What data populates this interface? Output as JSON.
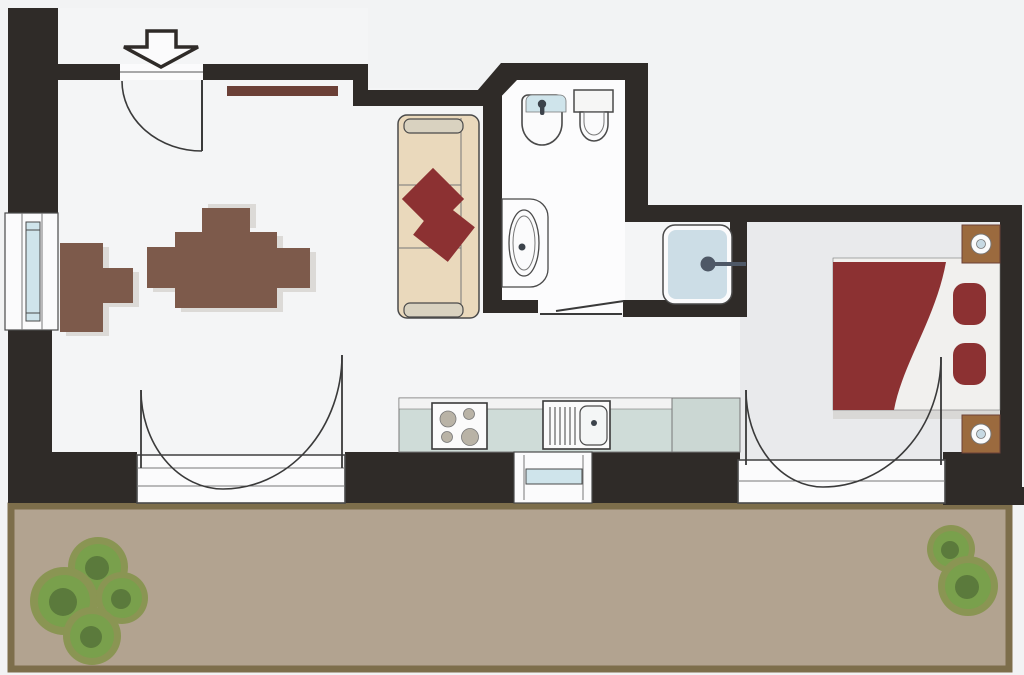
{
  "plan": {
    "type": "apartment-floor-plan",
    "rooms": [
      "living-room",
      "kitchen",
      "bathroom",
      "shower-niche",
      "bedroom",
      "terrace"
    ],
    "fixtures": [
      "entrance-arrow",
      "entrance-door",
      "wall-shelf",
      "armchair",
      "dining-table",
      "dining-chairs",
      "sofa",
      "sofa-pillows",
      "bidet",
      "toilet",
      "bathroom-sink",
      "sliding-door",
      "shower",
      "kitchen-counter",
      "stove",
      "kitchen-sink",
      "kitchen-window",
      "left-window",
      "french-door-living",
      "french-door-bedroom",
      "bed",
      "bed-pillows",
      "nightstands",
      "nightstand-lamps",
      "bushes"
    ]
  },
  "colors": {
    "background": "#f2f3f4",
    "wall": "#2f2b28",
    "floorLiving": "#f4f5f6",
    "floorBath": "#fcfcfd",
    "floorBedroom": "#e9eaec",
    "terraceFill": "#b2a390",
    "terraceBorder": "#7d6e4b",
    "glass": "#cfe4eb",
    "white": "#fbfbfc",
    "sofaBody": "#ead9bc",
    "sofaCap": "#d9d2c0",
    "accentRed": "#8c3132",
    "shelfWood": "#6b4037",
    "chairBrown": "#7d5a4b",
    "nightstandWood": "#9b6a3e",
    "counterFill": "#cfdcd8",
    "counterCabinet": "#cbd7d3",
    "counterTopStrip": "#f2f3f3",
    "applianceWhite": "#fbfbfb",
    "burnerGray": "#b9b3a6",
    "basinFill": "#f4f6f6",
    "shadow": "#dcdad7",
    "bedBase": "#f1f0ee",
    "bedShadow": "#d9d8d6",
    "showerFill": "#ccdde6",
    "handleSlate": "#4e5866",
    "lampBlue": "#c7d9e3",
    "fixtureDark": "#3c434b",
    "outline": "#4a4a4a",
    "doorLine": "#3a3a3a",
    "lineSoft": "#777777",
    "bushOuter": "#8a9553",
    "bushMid": "#79a04c",
    "bushCore": "#5b7a3c",
    "tankFill": "#f6f6f5"
  }
}
